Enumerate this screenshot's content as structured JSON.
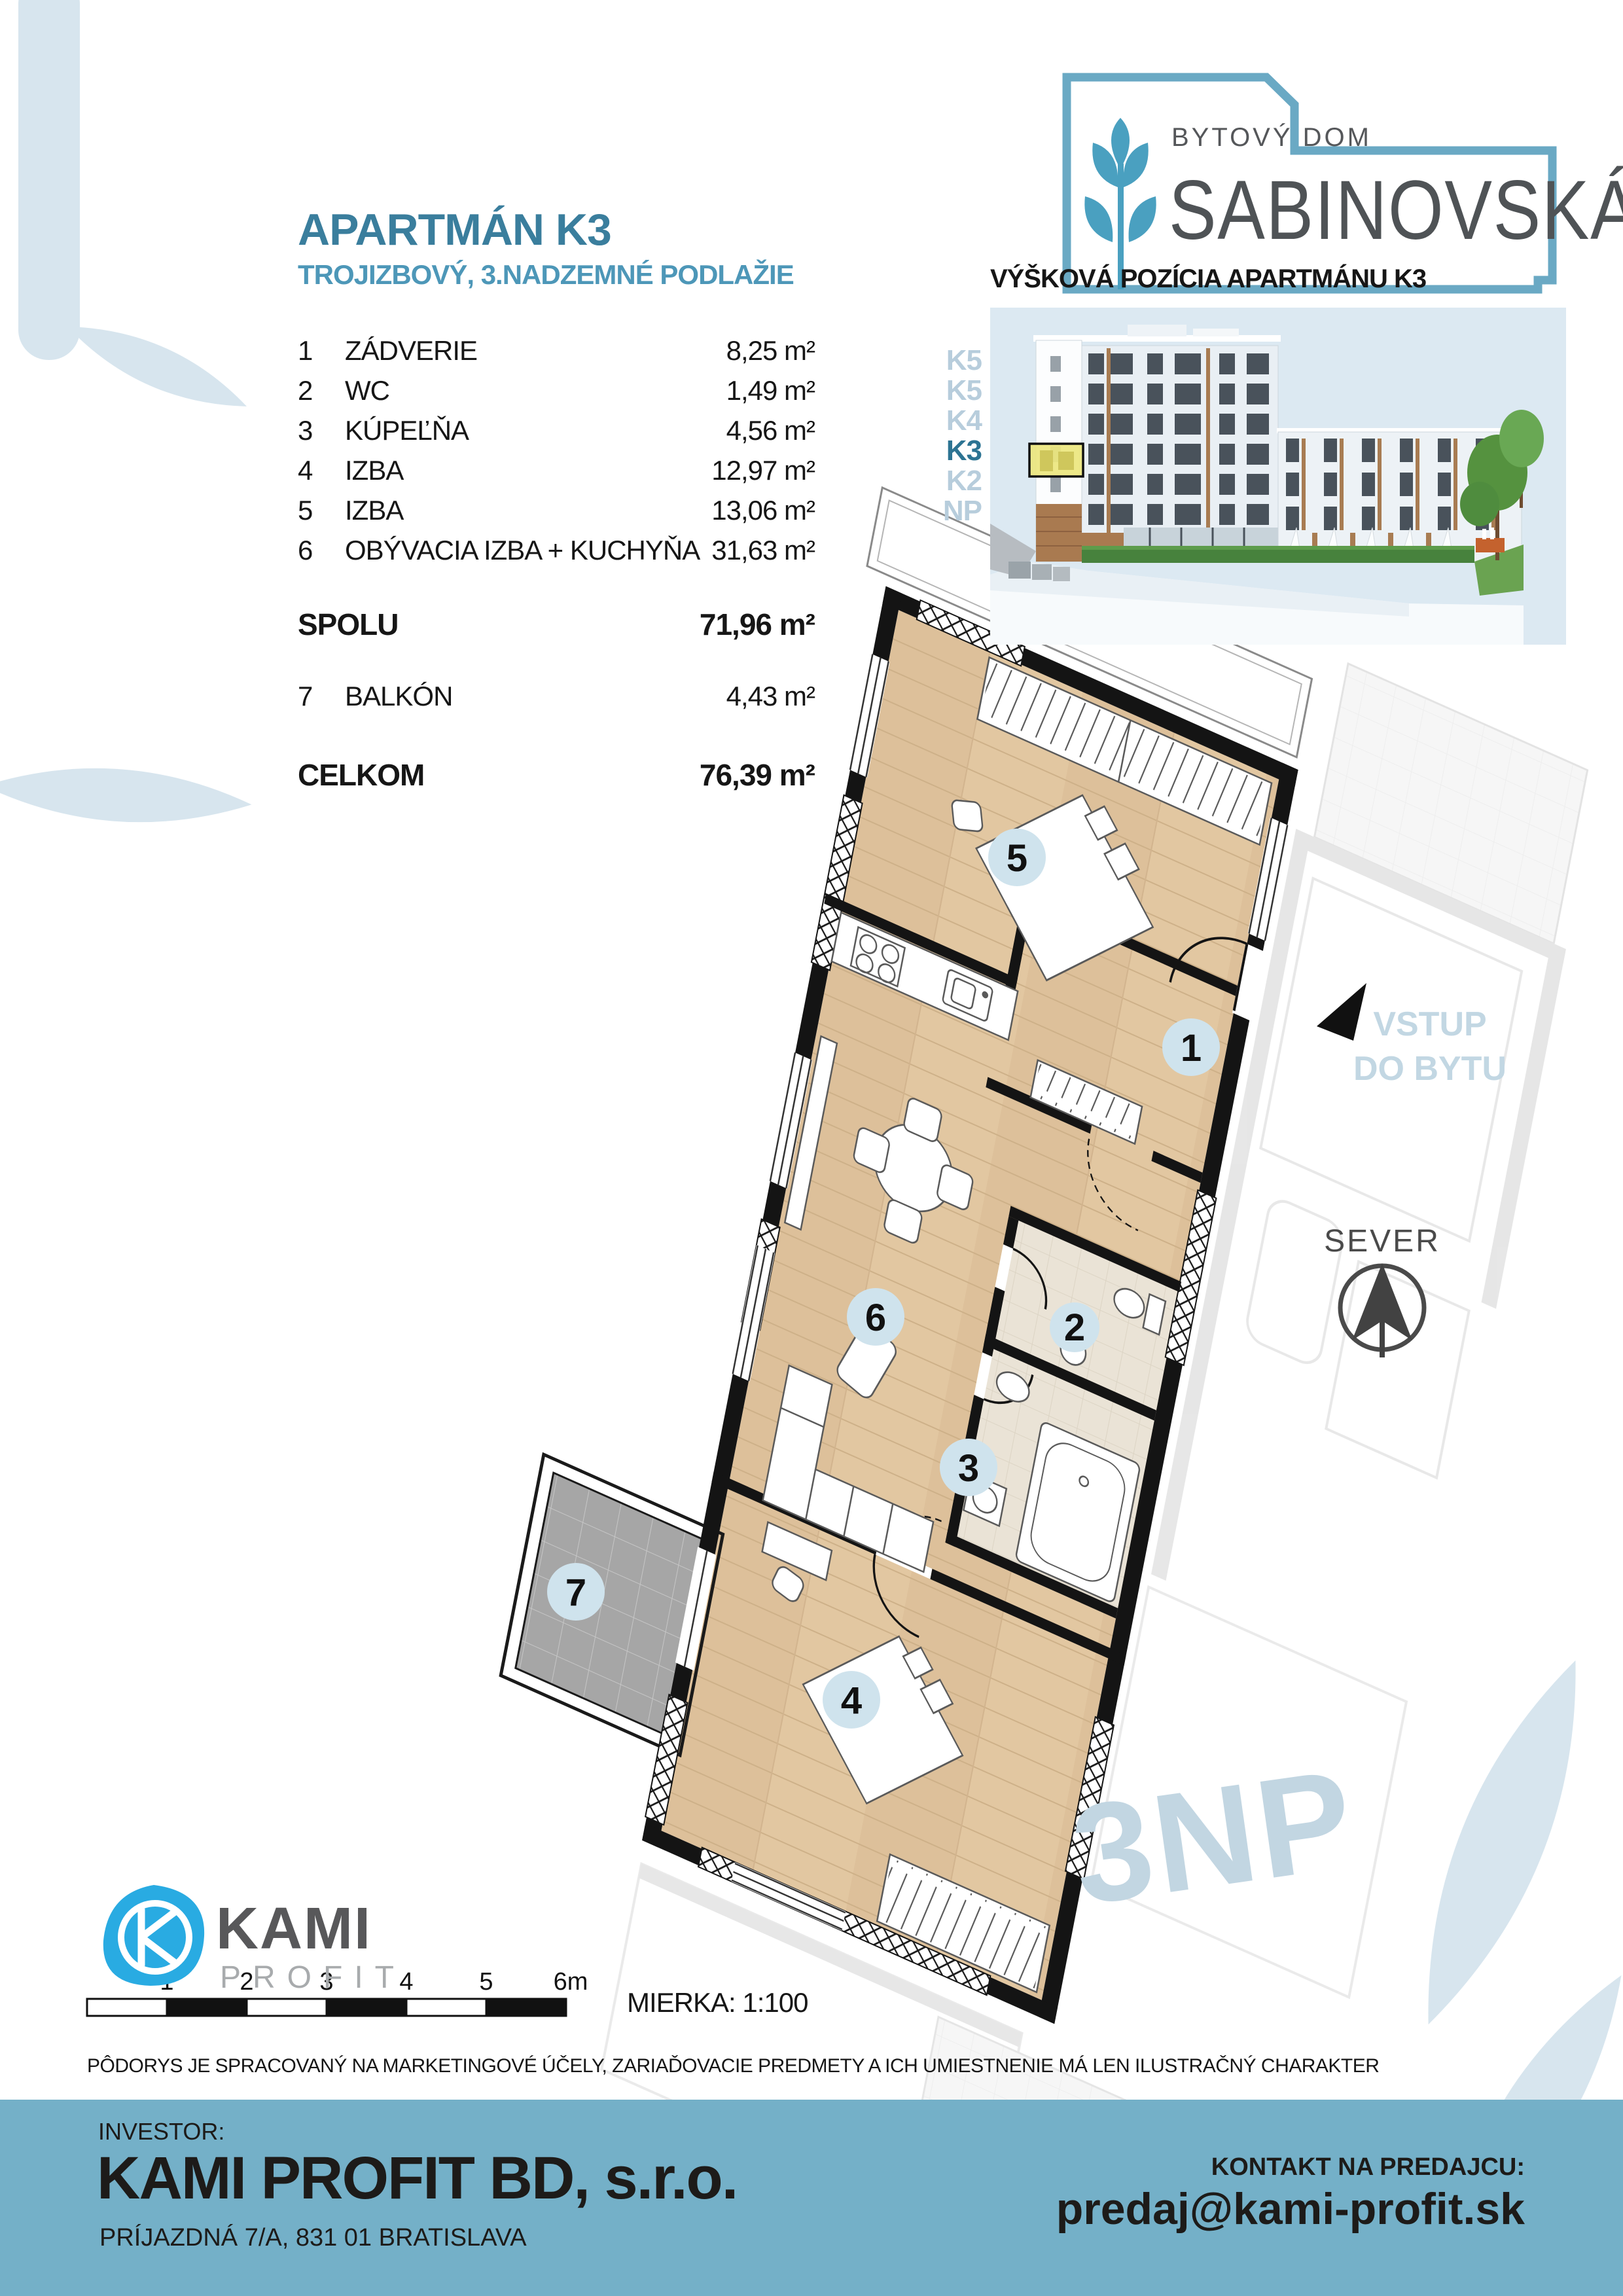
{
  "header": {
    "title": "APARTMÁN K3",
    "subtitle": "TROJIZBOVÝ, 3.NADZEMNÉ PODLAŽIE"
  },
  "brand": {
    "top": "BYTOVÝ DOM",
    "name": "SABINOVSKÁ"
  },
  "rooms": {
    "items": [
      {
        "num": "1",
        "name": "ZÁDVERIE",
        "area": "8,25 m²"
      },
      {
        "num": "2",
        "name": "WC",
        "area": "1,49 m²"
      },
      {
        "num": "3",
        "name": "KÚPEĽŇA",
        "area": "4,56 m²"
      },
      {
        "num": "4",
        "name": "IZBA",
        "area": "12,97 m²"
      },
      {
        "num": "5",
        "name": "IZBA",
        "area": "13,06 m²"
      },
      {
        "num": "6",
        "name": "OBÝVACIA IZBA + KUCHYŇA",
        "area": "31,63 m²"
      }
    ],
    "total_label": "SPOLU",
    "total_area": "71,96 m²",
    "balcony": {
      "num": "7",
      "name": "BALKÓN",
      "area": "4,43 m²"
    },
    "grand_label": "CELKOM",
    "grand_area": "76,39 m²"
  },
  "elevation": {
    "heading": "VÝŠKOVÁ POZÍCIA APARTMÁNU K3",
    "floor_labels": [
      "K5",
      "K5",
      "K4",
      "K3",
      "K2",
      "NP"
    ],
    "highlight_floor": "K3"
  },
  "plan": {
    "entry1": "VSTUP",
    "entry2": "DO BYTU",
    "north": "SEVER",
    "watermark": "3NP",
    "room_numbers": [
      "1",
      "2",
      "3",
      "4",
      "5",
      "6",
      "7"
    ]
  },
  "scale": {
    "ticks": [
      "1",
      "2",
      "3",
      "4",
      "5",
      "6m"
    ],
    "label": "MIERKA: 1:100"
  },
  "disclaimer": "PÔDORYS JE SPRACOVANÝ NA MARKETINGOVÉ ÚČELY, ZARIAĎOVACIE PREDMETY A ICH UMIESTNENIE MÁ LEN ILUSTRAČNÝ CHARAKTER",
  "footer": {
    "investor_label": "INVESTOR:",
    "investor_name": "KAMI PROFIT BD, s.r.o.",
    "investor_address": "PRÍJAZDNÁ 7/A, 831 01 BRATISLAVA",
    "contact_label": "KONTAKT NA PREDAJCU:",
    "contact_email": "predaj@kami-profit.sk"
  },
  "logo": {
    "kami": "KAMI",
    "profit": "PROFIT"
  },
  "colors": {
    "accent_teal": "#3a7e9d",
    "light_teal": "#4d97b8",
    "panel_sky": "#dce9f2",
    "petal_blue": "#d7e5ee",
    "footer_blue": "#74b0c8",
    "highlight_yellow": "#ebe67e",
    "floor_label_blue": "#b7cddc",
    "floor_label_active": "#2d7493",
    "plan_text_blue": "#c2d7e3",
    "room_circle": "#cfe3ed",
    "wood": "#e2c7a1",
    "kami_blue": "#29abe2"
  }
}
